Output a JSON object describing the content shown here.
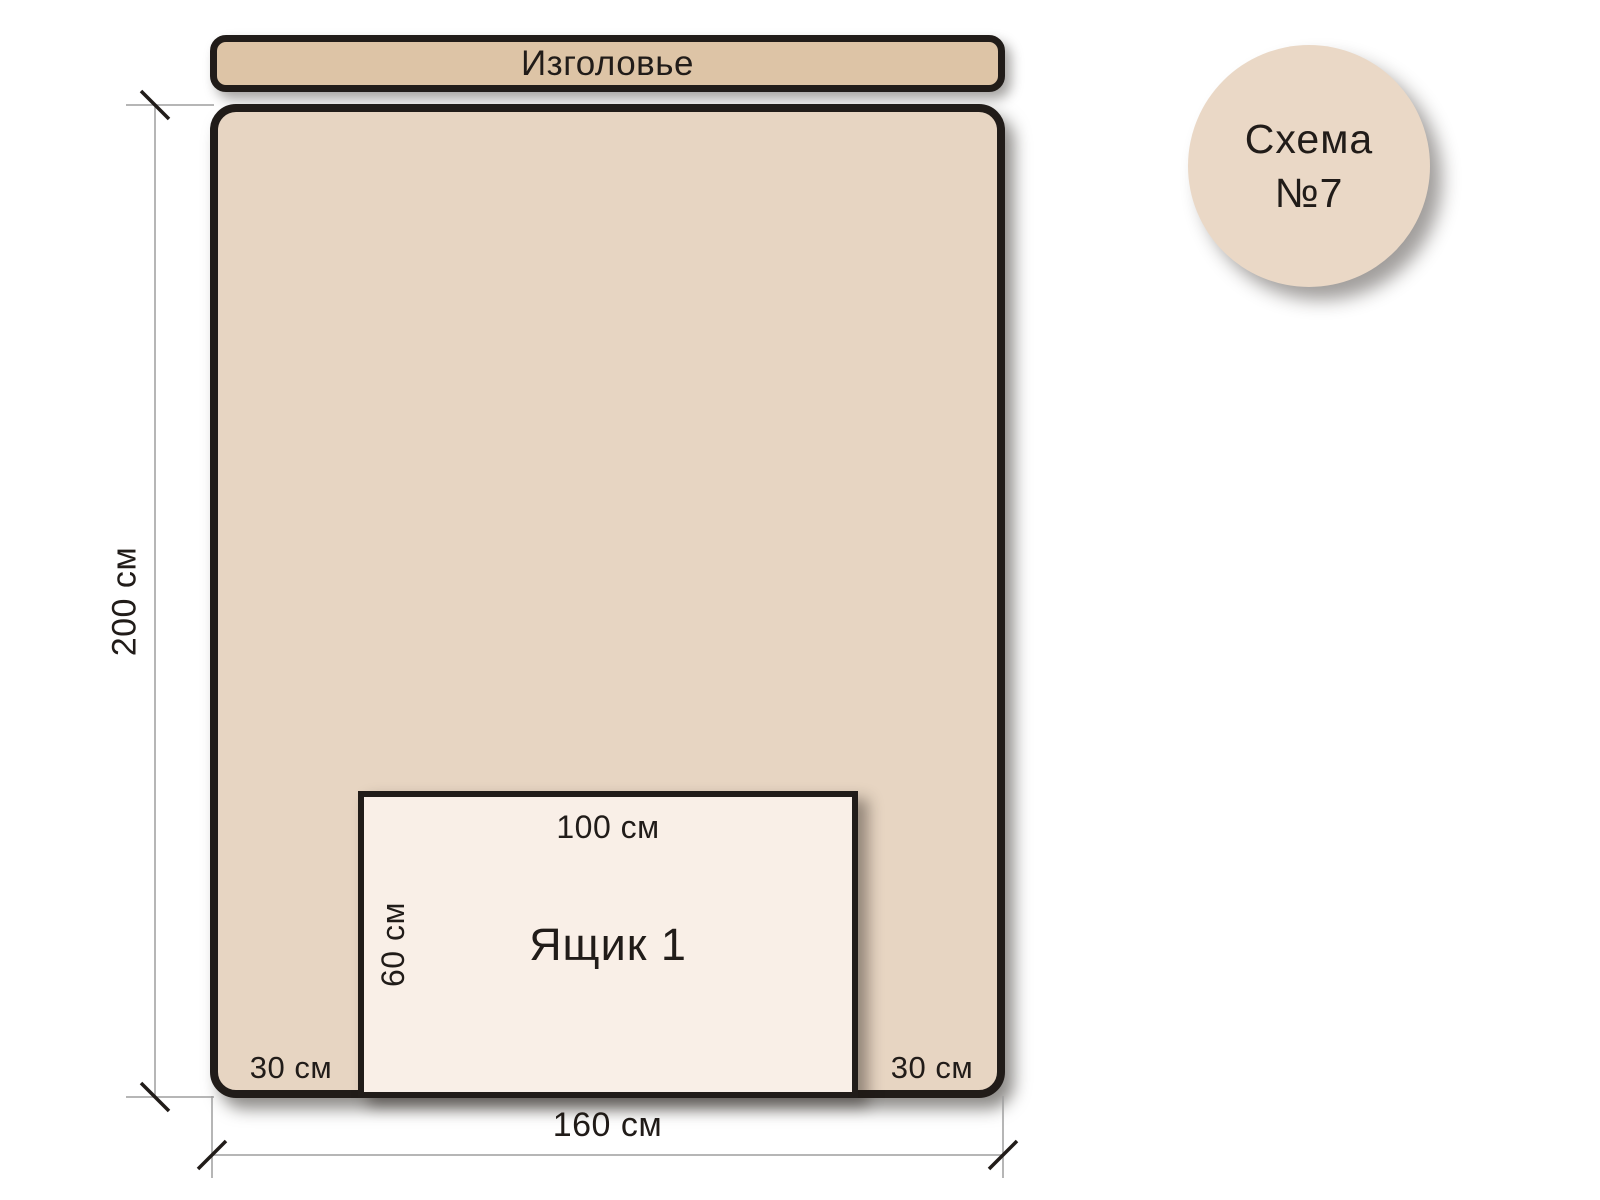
{
  "badge": {
    "title": "Схема",
    "number": "№7"
  },
  "headboard": {
    "label": "Изголовье"
  },
  "bed": {
    "height_dimension": "200 см",
    "width_dimension": "160 см",
    "left_margin": "30 см",
    "right_margin": "30 см"
  },
  "drawer": {
    "label": "Ящик 1",
    "width_dimension": "100 см",
    "height_dimension": "60 см"
  },
  "colors": {
    "background": "#ffffff",
    "headboard_fill": "#ddc4a6",
    "bed_fill": "#e7d5c2",
    "drawer_fill": "#f9efe7",
    "badge_fill": "#ead8c6",
    "ink": "#211c19",
    "dimension_line": "#9e9e9e"
  }
}
